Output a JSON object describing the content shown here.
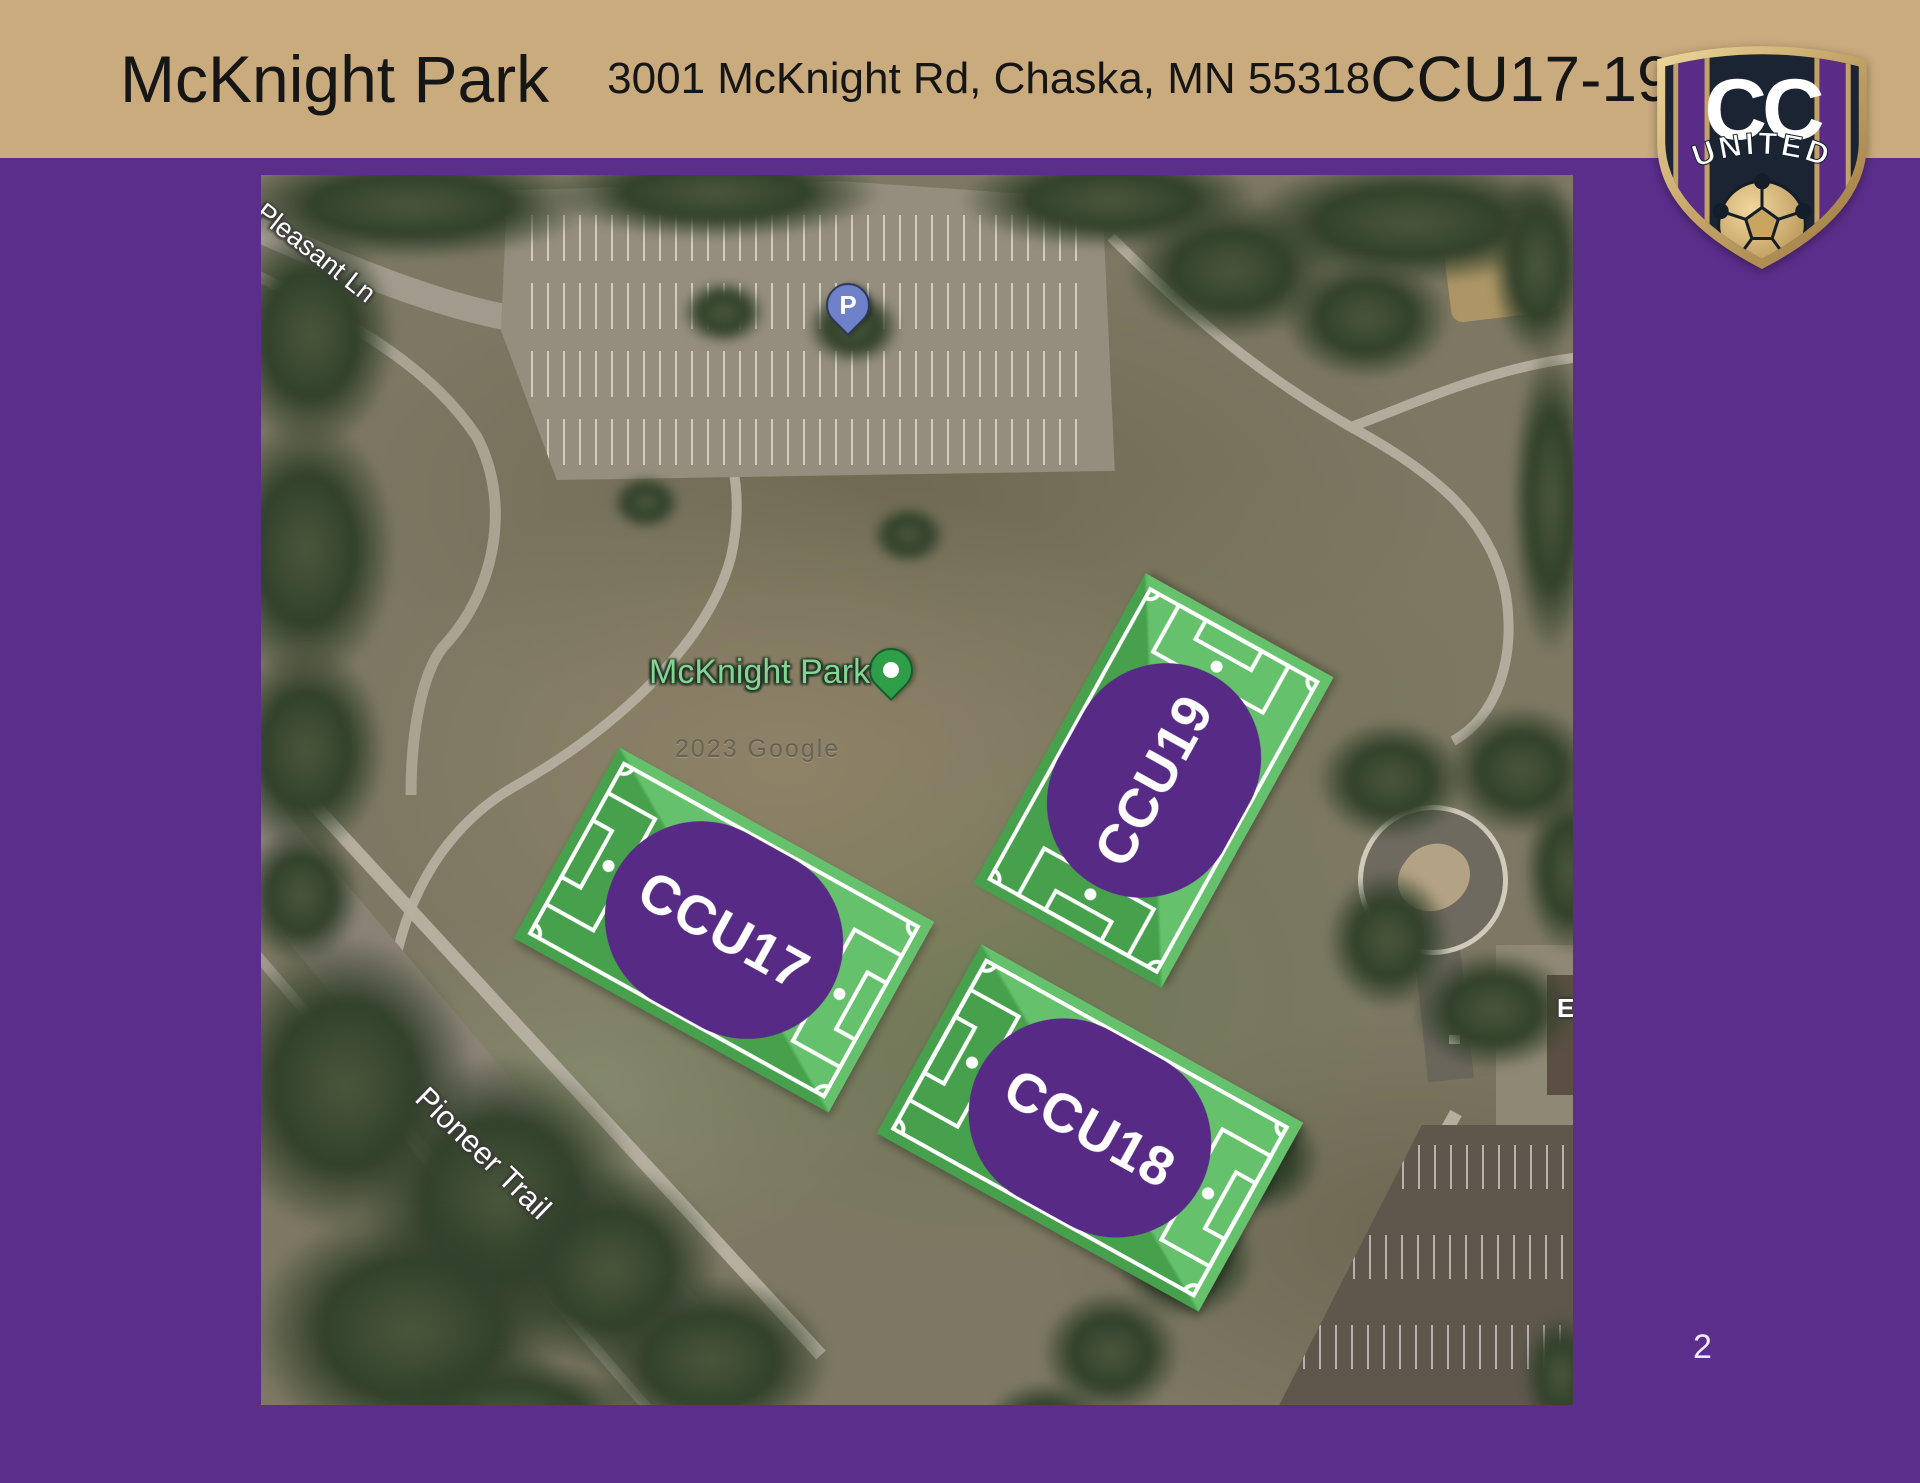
{
  "banner": {
    "title": "McKnight Park",
    "address": "3001 McKnight Rd, Chaska, MN 55318",
    "group_label": "CCU17-19"
  },
  "logo": {
    "top_text": "CC",
    "bottom_text": "UNITED"
  },
  "map": {
    "park_label": "McKnight Park",
    "road_labels": {
      "pleasant": "Pleasant Ln",
      "pioneer": "Pioneer Trail"
    },
    "parking_pin": "P",
    "watermark": "2023 Google",
    "edge_label": "E",
    "fields": [
      {
        "name": "CCU17"
      },
      {
        "name": "CCU18"
      },
      {
        "name": "CCU19"
      }
    ]
  },
  "page_number": "2",
  "colors": {
    "background_purple": "#5c2e8c",
    "banner_tan": "#c9ab7d",
    "field_green": "#46a04c",
    "field_green_light": "#65c16b",
    "label_purple": "#572b85",
    "logo_navy": "#1a2433",
    "logo_gold": "#c2a266",
    "park_pin_green": "#2f9e49",
    "parking_pin_blue": "#6f82c9"
  }
}
